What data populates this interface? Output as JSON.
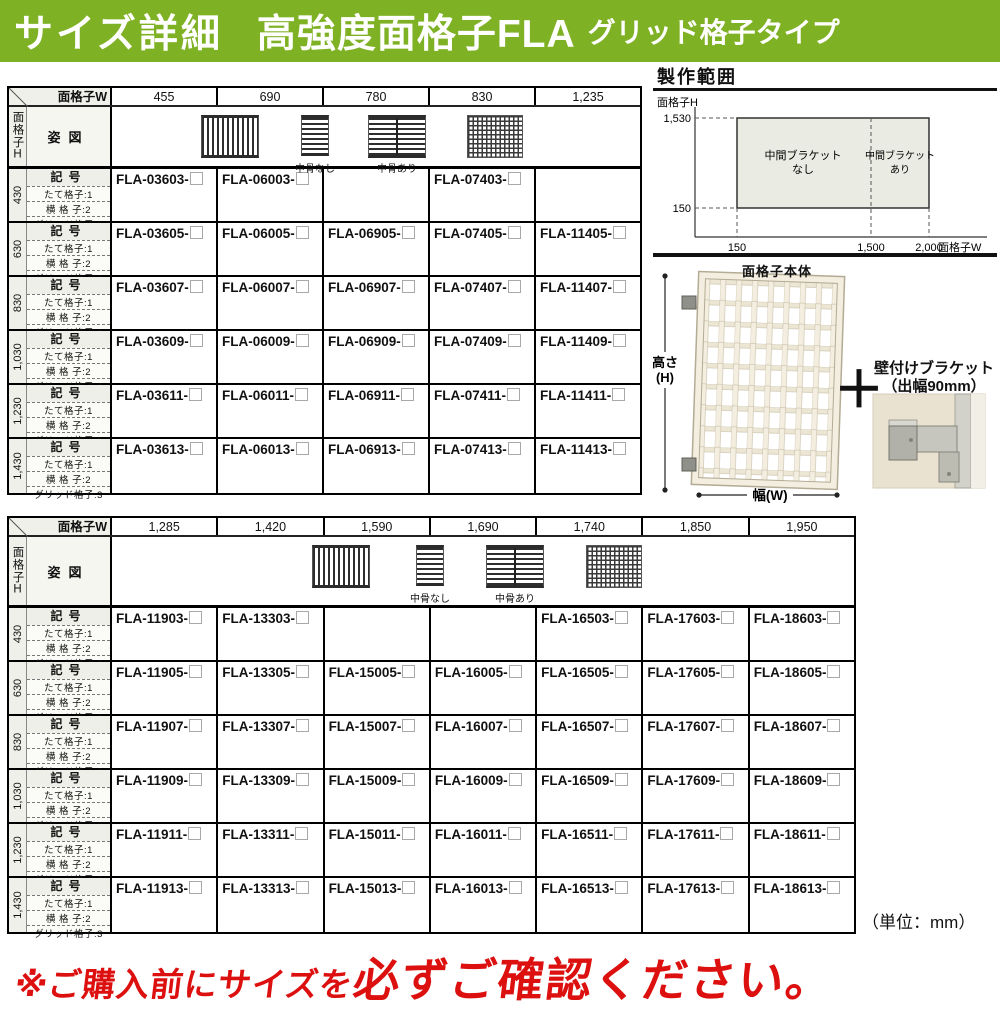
{
  "header": {
    "title_main": "サイズ詳細",
    "title_product": "高強度面格子FLA",
    "title_type": "グリッド格子タイプ"
  },
  "tables": {
    "labels": {
      "width_axis": "面格子W",
      "height_axis": "面格子H",
      "figure": "姿図",
      "code": "記号",
      "sub1": "たて格子:1",
      "sub2": "横 格 子:2",
      "sub3": "グリッド格子:3",
      "no_midrib": "中骨なし",
      "with_midrib": "中骨あり"
    },
    "table1": {
      "widths": [
        "455",
        "690",
        "780",
        "830",
        "1,235"
      ],
      "rows": [
        {
          "height": "430",
          "codes": [
            "FLA-03603-",
            "FLA-06003-",
            null,
            "FLA-07403-",
            null
          ]
        },
        {
          "height": "630",
          "codes": [
            "FLA-03605-",
            "FLA-06005-",
            "FLA-06905-",
            "FLA-07405-",
            "FLA-11405-"
          ]
        },
        {
          "height": "830",
          "codes": [
            "FLA-03607-",
            "FLA-06007-",
            "FLA-06907-",
            "FLA-07407-",
            "FLA-11407-"
          ]
        },
        {
          "height": "1,030",
          "codes": [
            "FLA-03609-",
            "FLA-06009-",
            "FLA-06909-",
            "FLA-07409-",
            "FLA-11409-"
          ]
        },
        {
          "height": "1,230",
          "codes": [
            "FLA-03611-",
            "FLA-06011-",
            "FLA-06911-",
            "FLA-07411-",
            "FLA-11411-"
          ]
        },
        {
          "height": "1,430",
          "codes": [
            "FLA-03613-",
            "FLA-06013-",
            "FLA-06913-",
            "FLA-07413-",
            "FLA-11413-"
          ]
        }
      ]
    },
    "table2": {
      "widths": [
        "1,285",
        "1,420",
        "1,590",
        "1,690",
        "1,740",
        "1,850",
        "1,950"
      ],
      "rows": [
        {
          "height": "430",
          "codes": [
            "FLA-11903-",
            "FLA-13303-",
            null,
            null,
            "FLA-16503-",
            "FLA-17603-",
            "FLA-18603-"
          ]
        },
        {
          "height": "630",
          "codes": [
            "FLA-11905-",
            "FLA-13305-",
            "FLA-15005-",
            "FLA-16005-",
            "FLA-16505-",
            "FLA-17605-",
            "FLA-18605-"
          ]
        },
        {
          "height": "830",
          "codes": [
            "FLA-11907-",
            "FLA-13307-",
            "FLA-15007-",
            "FLA-16007-",
            "FLA-16507-",
            "FLA-17607-",
            "FLA-18607-"
          ]
        },
        {
          "height": "1,030",
          "codes": [
            "FLA-11909-",
            "FLA-13309-",
            "FLA-15009-",
            "FLA-16009-",
            "FLA-16509-",
            "FLA-17609-",
            "FLA-18609-"
          ]
        },
        {
          "height": "1,230",
          "codes": [
            "FLA-11911-",
            "FLA-13311-",
            "FLA-15011-",
            "FLA-16011-",
            "FLA-16511-",
            "FLA-17611-",
            "FLA-18611-"
          ]
        },
        {
          "height": "1,430",
          "codes": [
            "FLA-11913-",
            "FLA-13313-",
            "FLA-15013-",
            "FLA-16013-",
            "FLA-16513-",
            "FLA-17613-",
            "FLA-18613-"
          ]
        }
      ]
    }
  },
  "diagram": {
    "title": "製作範囲",
    "y_axis": "面格子H",
    "x_axis": "面格子W",
    "y_max": "1,530",
    "y_min": "150",
    "x_min": "150",
    "x_mid": "1,500",
    "x_max": "2,000",
    "zone_left1": "中間ブラケット",
    "zone_left2": "なし",
    "zone_right1": "中間ブラケット",
    "zone_right2": "あり"
  },
  "product": {
    "body_label": "面格子本体",
    "dim_h1": "高さ",
    "dim_h2": "(H)",
    "dim_w": "幅(W)",
    "plus": "＋",
    "bracket1": "壁付けブラケット",
    "bracket2": "（出幅90mm）"
  },
  "footer": {
    "unit": "（単位：mm）",
    "warn_a": "※ご購入前にサイズを",
    "warn_b": "必ずご確認ください。"
  },
  "colors": {
    "header_green": "#7fb125",
    "warning_red": "#dd1010"
  }
}
